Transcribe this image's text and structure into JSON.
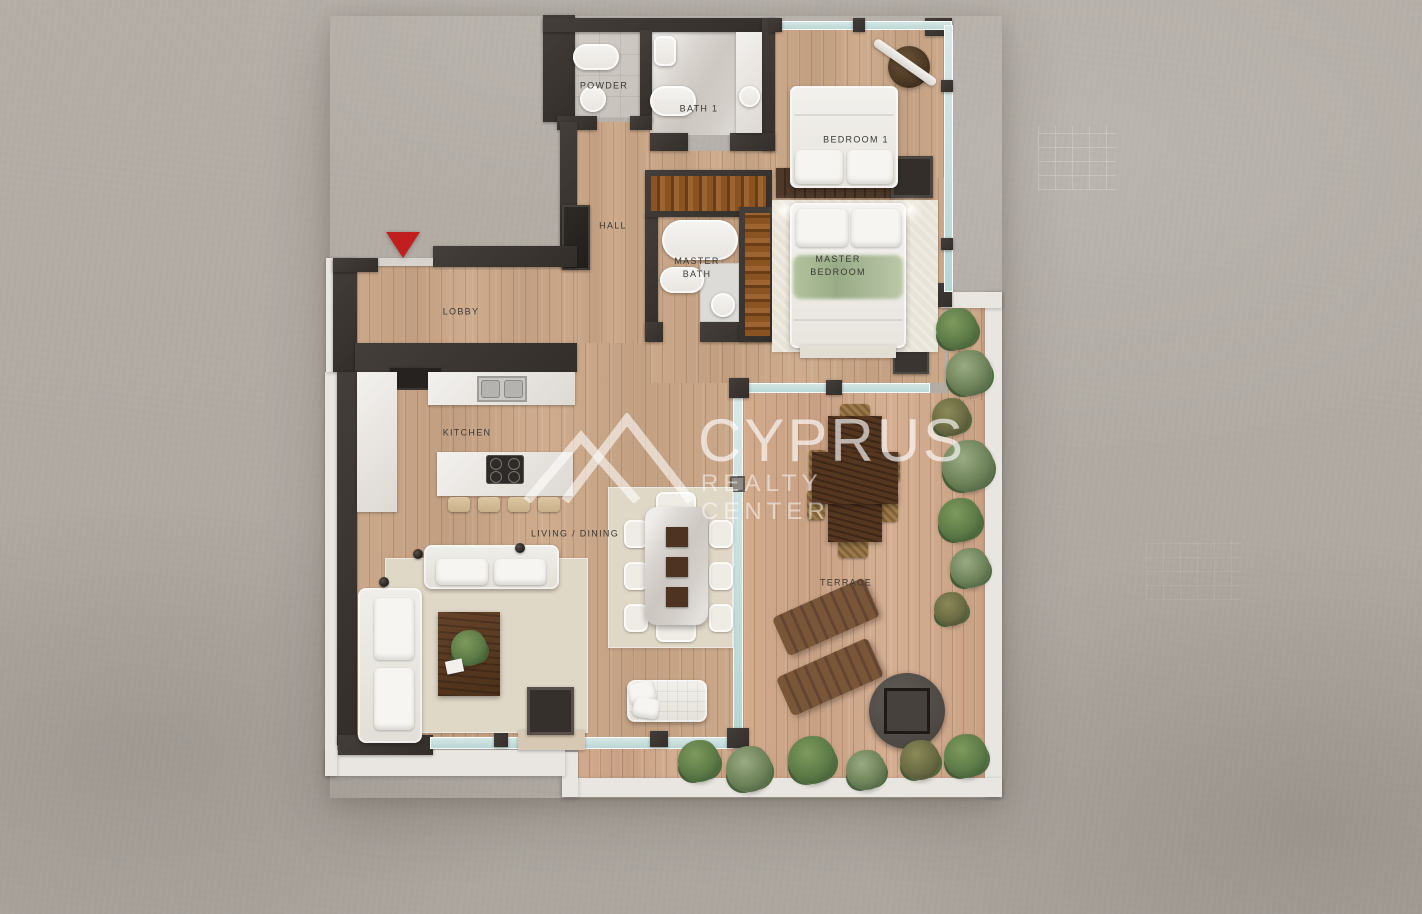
{
  "labels": {
    "powder": "POWDER",
    "bath1": "BATH 1",
    "bedroom1": "BEDROOM 1",
    "hall": "HALL",
    "master_bath_l1": "MASTER",
    "master_bath_l2": "BATH",
    "master_bedroom_l1": "MASTER",
    "master_bedroom_l2": "BEDROOM",
    "lobby": "LOBBY",
    "kitchen": "KITCHEN",
    "living_dining": "LIVING / DINING",
    "terrace": "TERRACE"
  },
  "watermark": {
    "brand": "CYPRUS",
    "tagline": "REALTY CENTER"
  },
  "colors": {
    "background_concrete": "#b1aba4",
    "wall": "#3b3532",
    "interior_wood_floor": "#c7a486",
    "terrace_wood_floor": "#cda68a",
    "glass_wall": "#bcd8d6",
    "terrace_parapet": "#e9e6e1",
    "closet_wood": "#8a5322",
    "entry_arrow": "#c11f1f",
    "watermark_text": "#ffffff"
  }
}
